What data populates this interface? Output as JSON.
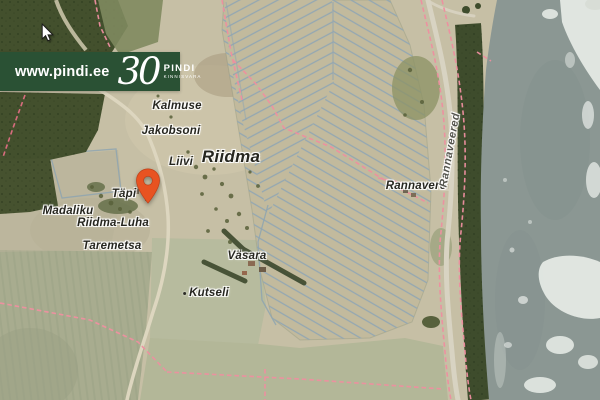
{
  "branding": {
    "website": "www.pindi.ee",
    "anniversary": "30",
    "name": "PINDI",
    "subtitle": "KINNISVARA",
    "banner_color": "#2a5134"
  },
  "map": {
    "labels": {
      "kalmuse": "Kalmuse",
      "jakobsoni": "Jakobsoni",
      "liivi": "Liivi",
      "riidma": "Riidma",
      "tapi": "Täpi",
      "madaliku": "Madaliku",
      "riidma_luha": "Riidma-Luha",
      "taremetsa": "Taremetsa",
      "vasara": "Väsara",
      "kutseli": "Kutseli",
      "rannavere": "Rannavere",
      "rannaveered": "Rannaveered"
    },
    "marker_color": "#e85321",
    "colors": {
      "water": "#8b9793",
      "ice": "#e9ede9",
      "field": "#c6bfa5",
      "forest": "#43502d",
      "cadastral_boundary": "#ef8fa0",
      "drainage_ditch": "#8ea4b0"
    }
  }
}
